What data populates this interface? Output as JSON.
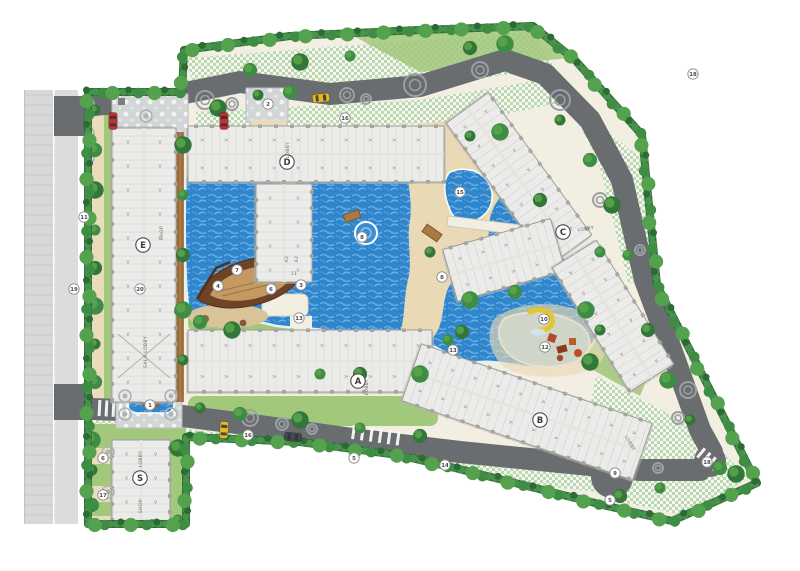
{
  "palette": {
    "water": "#2f86cc",
    "water_light": "#7ab9ea",
    "water_kids": "#a6d3ee",
    "sand": "#e9d9b5",
    "deck": "#f2eee2",
    "lawn": "#a2c87c",
    "hedge": "#2c6b35",
    "tree": "#3f8c45",
    "tree_light": "#5aa64e",
    "road": "#696d70",
    "road_motif": "#9aa0a3",
    "checker_green": "#bdd7ae",
    "building": "#ebebe9",
    "building_line": "#9b9b98",
    "boardwalk": "#a87a45",
    "boat_hull": "#6f4426",
    "boat_deck": "#c49a62",
    "slide": "#e3c52e",
    "play": "#b04a28",
    "car_red": "#c4322e",
    "car_yellow": "#e8b821",
    "car_dark": "#45494d",
    "marker_stroke": "#8b8b8b",
    "label_text": "#3c3c3c"
  },
  "building_labels": [
    {
      "text": "D",
      "x": 287,
      "y": 162
    },
    {
      "text": "E",
      "x": 143,
      "y": 245
    },
    {
      "text": "C",
      "x": 563,
      "y": 232
    },
    {
      "text": "A",
      "x": 358,
      "y": 381
    },
    {
      "text": "B",
      "x": 540,
      "y": 420
    },
    {
      "text": "S",
      "x": 140,
      "y": 478
    }
  ],
  "plan_texts": [
    {
      "text": "LOBBY",
      "x": 289,
      "y": 150,
      "rot": -90
    },
    {
      "text": "SALA LOBBY",
      "x": 147,
      "y": 352,
      "rot": -90
    },
    {
      "text": "SHOP",
      "x": 163,
      "y": 233,
      "rot": -90
    },
    {
      "text": "LOBBY",
      "x": 586,
      "y": 230,
      "rot": -8
    },
    {
      "text": "LOBBY",
      "x": 368,
      "y": 387,
      "rot": -90
    },
    {
      "text": "LOBBY",
      "x": 629,
      "y": 444,
      "rot": 58
    },
    {
      "text": "LOBBY",
      "x": 142,
      "y": 459,
      "rot": -90
    },
    {
      "text": "SHOP",
      "x": 142,
      "y": 506,
      "rot": -90
    },
    {
      "text": "A2",
      "x": 288,
      "y": 259,
      "rot": -90
    },
    {
      "text": "A2",
      "x": 298,
      "y": 259,
      "rot": -90
    },
    {
      "text": "11",
      "x": 294,
      "y": 275,
      "rot": 0
    }
  ],
  "unit_mark": "A",
  "markers": [
    {
      "n": "2",
      "x": 268,
      "y": 104
    },
    {
      "n": "16",
      "x": 345,
      "y": 118
    },
    {
      "n": "18",
      "x": 693,
      "y": 74
    },
    {
      "n": "11",
      "x": 84,
      "y": 217
    },
    {
      "n": "19",
      "x": 74,
      "y": 289
    },
    {
      "n": "20",
      "x": 140,
      "y": 289
    },
    {
      "n": "15",
      "x": 460,
      "y": 192
    },
    {
      "n": "8",
      "x": 362,
      "y": 237
    },
    {
      "n": "8",
      "x": 442,
      "y": 277
    },
    {
      "n": "7",
      "x": 237,
      "y": 270
    },
    {
      "n": "4",
      "x": 218,
      "y": 286
    },
    {
      "n": "6",
      "x": 271,
      "y": 289
    },
    {
      "n": "3",
      "x": 301,
      "y": 285
    },
    {
      "n": "13",
      "x": 299,
      "y": 318
    },
    {
      "n": "13",
      "x": 453,
      "y": 350
    },
    {
      "n": "10",
      "x": 544,
      "y": 319
    },
    {
      "n": "12",
      "x": 545,
      "y": 347
    },
    {
      "n": "1",
      "x": 150,
      "y": 405
    },
    {
      "n": "16",
      "x": 248,
      "y": 435
    },
    {
      "n": "5",
      "x": 354,
      "y": 458
    },
    {
      "n": "14",
      "x": 445,
      "y": 465
    },
    {
      "n": "9",
      "x": 615,
      "y": 473
    },
    {
      "n": "5",
      "x": 610,
      "y": 500
    },
    {
      "n": "18",
      "x": 707,
      "y": 462
    },
    {
      "n": "6",
      "x": 103,
      "y": 458
    },
    {
      "n": "17",
      "x": 103,
      "y": 495
    }
  ],
  "cars": [
    {
      "color_key": "car_red",
      "x": 113,
      "y": 121,
      "rot": 0
    },
    {
      "color_key": "car_red",
      "x": 224,
      "y": 121,
      "rot": 0
    },
    {
      "color_key": "car_yellow",
      "x": 321,
      "y": 98,
      "rot": 84
    },
    {
      "color_key": "car_yellow",
      "x": 224,
      "y": 430,
      "rot": 4
    },
    {
      "color_key": "car_dark",
      "x": 293,
      "y": 437,
      "rot": 96
    }
  ]
}
